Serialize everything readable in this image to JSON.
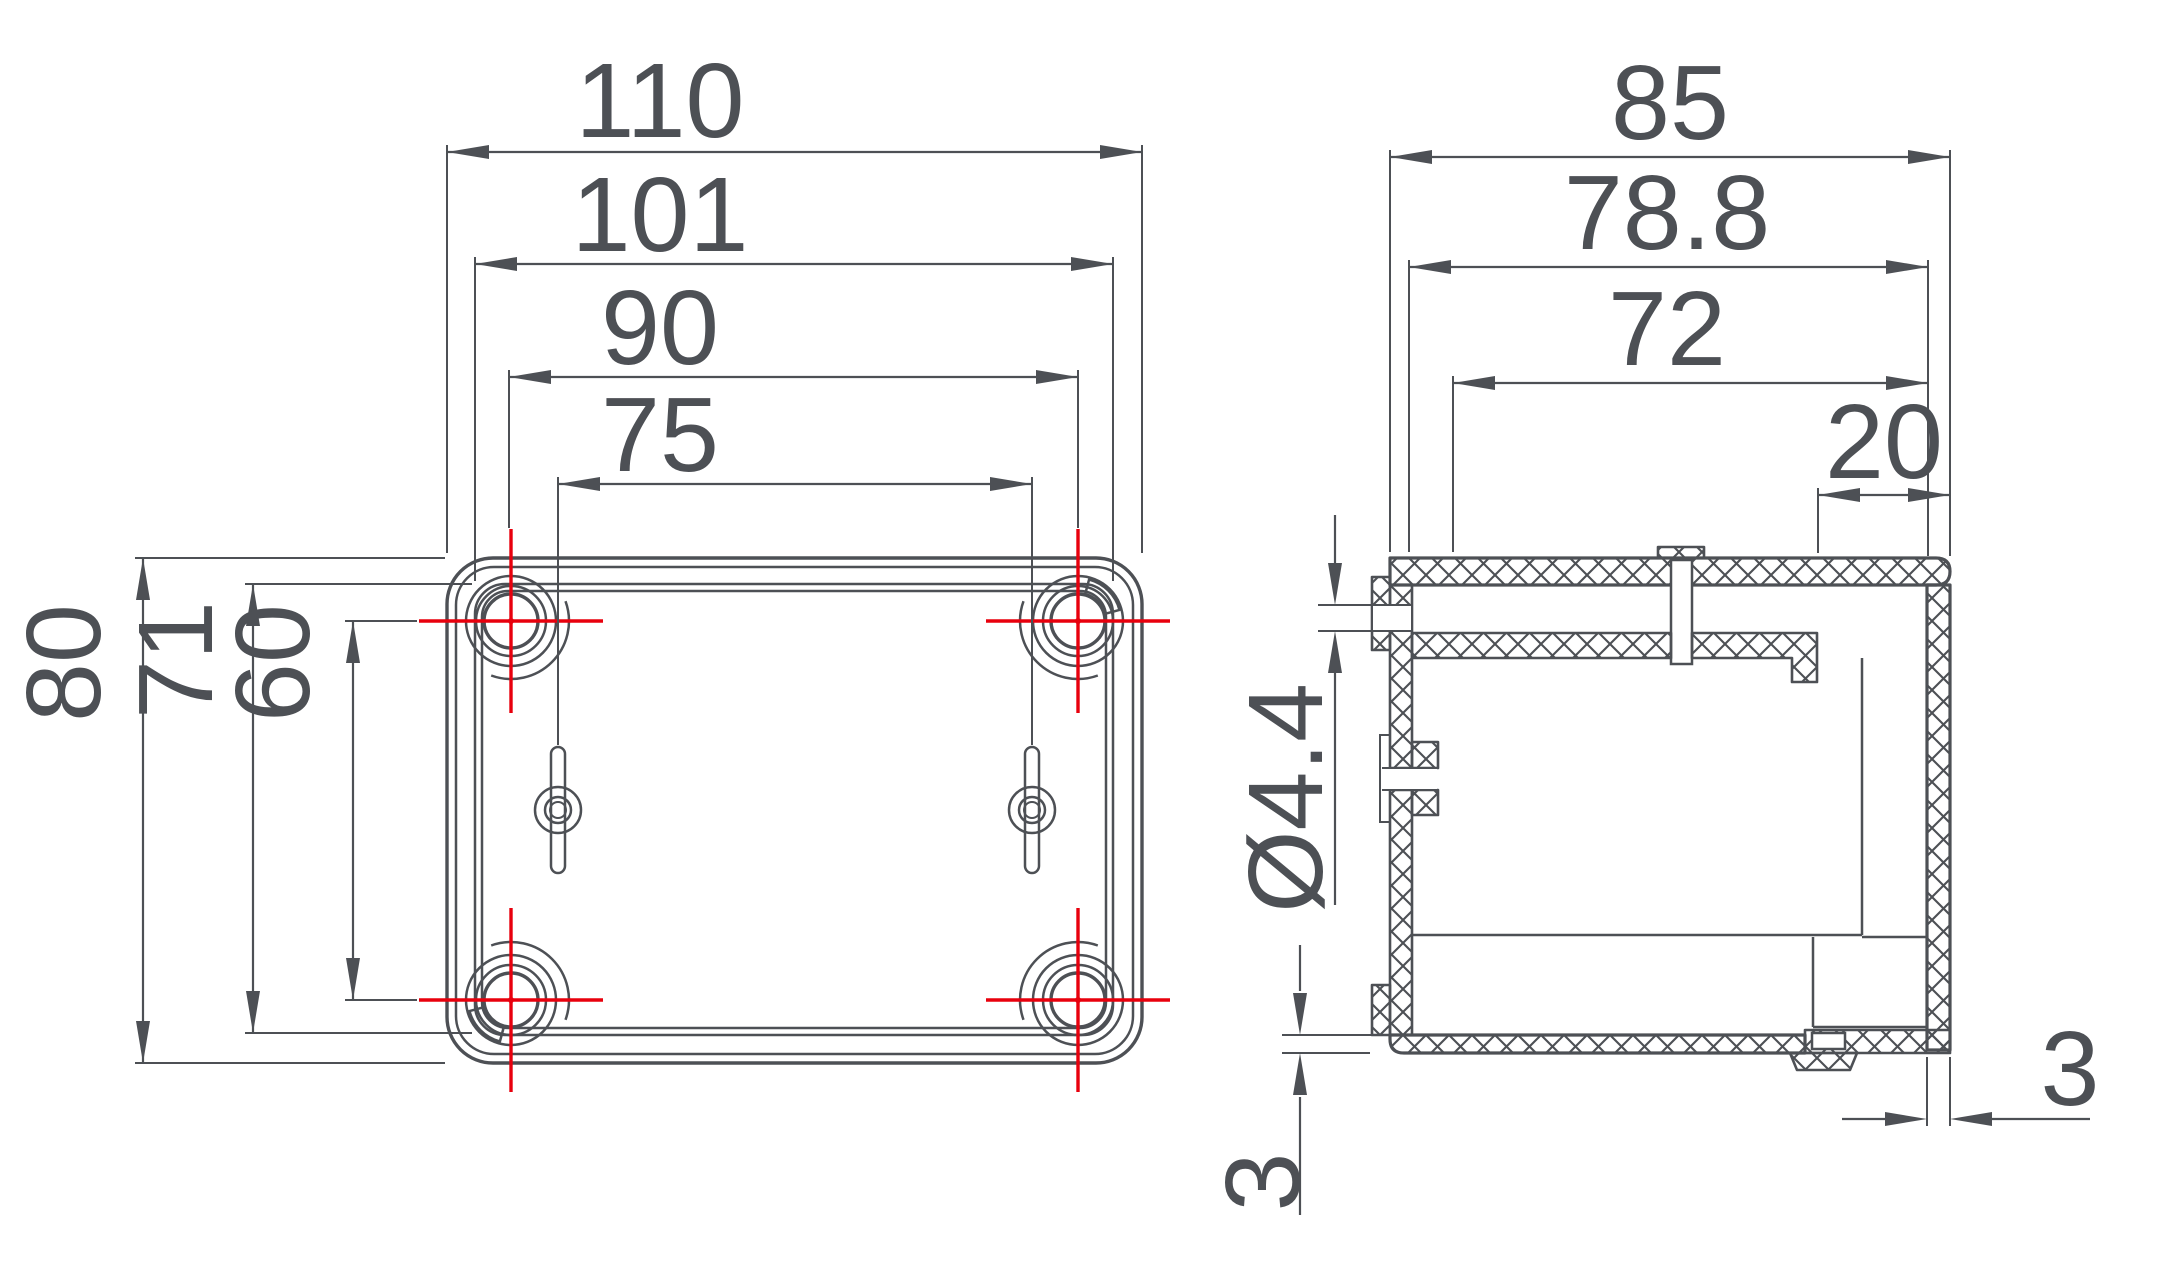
{
  "drawing": {
    "type": "technical-drawing",
    "units": "mm",
    "colors": {
      "line": "#4d5055",
      "centerline": "#e8000d",
      "background": "#ffffff"
    },
    "front_view": {
      "name": "enclosure-front-view",
      "width_dims": [
        "110",
        "101",
        "90",
        "75"
      ],
      "height_dims": [
        "80",
        "71",
        "60"
      ]
    },
    "side_view": {
      "name": "enclosure-side-section-view",
      "depth_dims": [
        "85",
        "78.8",
        "72",
        "20"
      ],
      "hole_diameter": "Ø4.4",
      "base_thickness": "3",
      "cover_thickness": "3"
    }
  }
}
